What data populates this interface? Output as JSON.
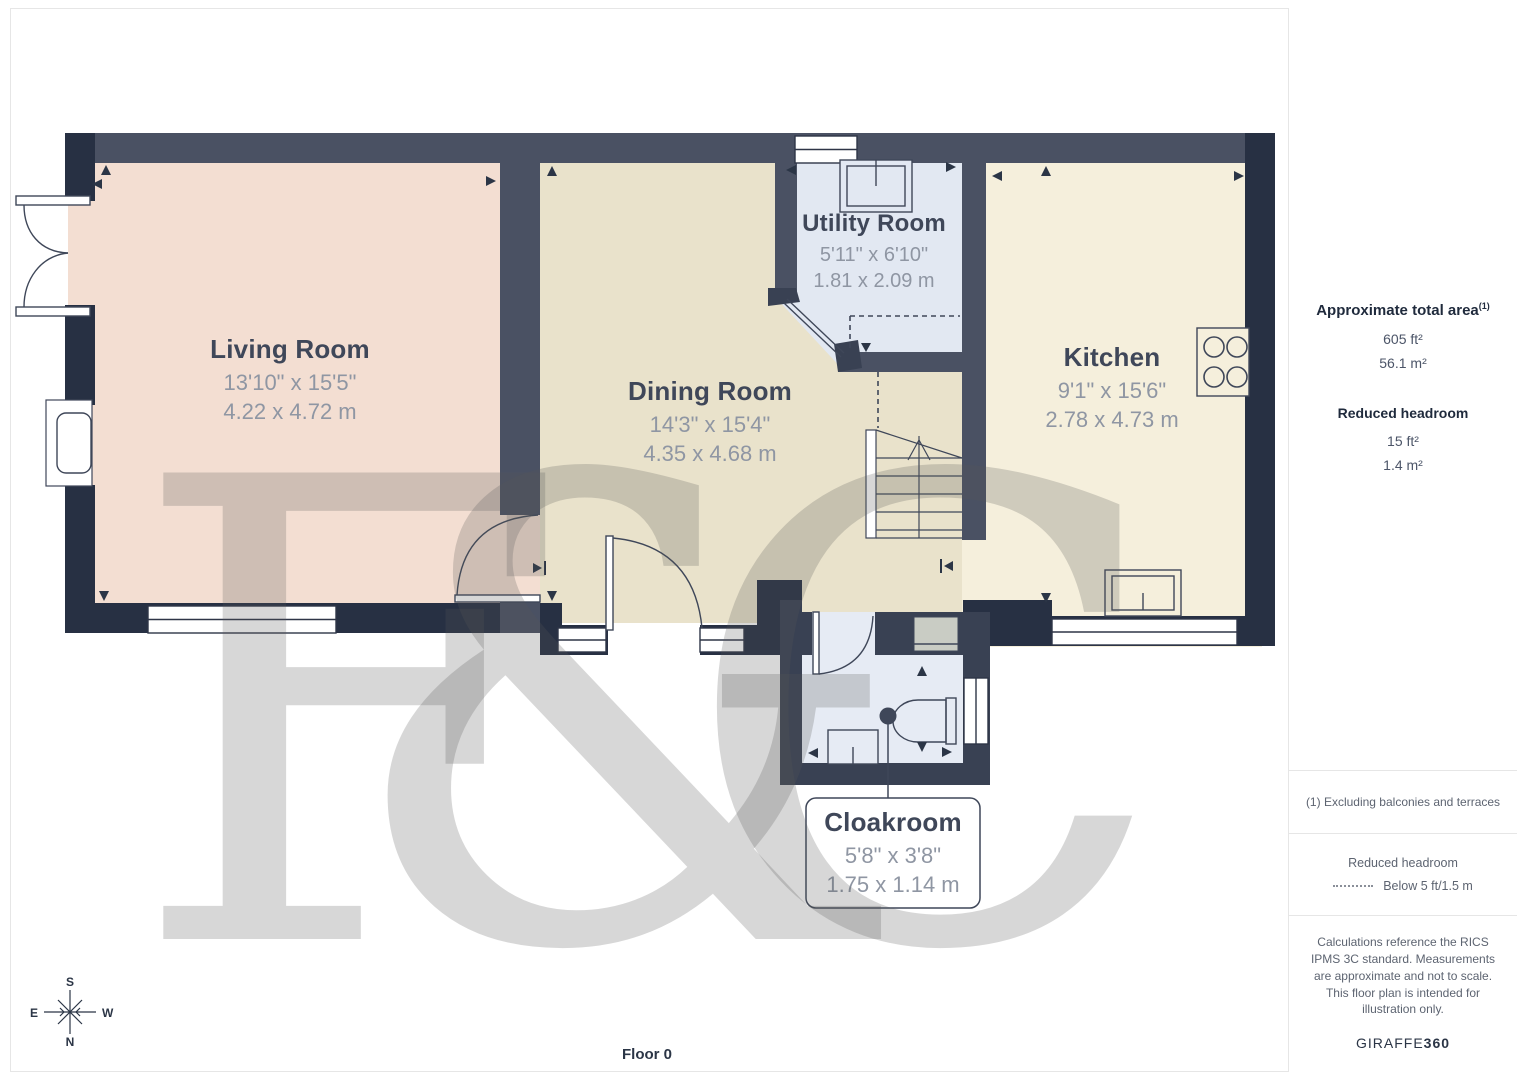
{
  "floor_label": "Floor 0",
  "watermark": "F&C",
  "compass": {
    "top": "S",
    "left": "E",
    "right": "W",
    "bottom": "N"
  },
  "rooms": [
    {
      "name": "Living Room",
      "imperial": "13'10\" x 15'5\"",
      "metric": "4.22 x 4.72 m"
    },
    {
      "name": "Dining Room",
      "imperial": "14'3\" x 15'4\"",
      "metric": "4.35 x 4.68 m"
    },
    {
      "name": "Utility Room",
      "imperial": "5'11\" x 6'10\"",
      "metric": "1.81 x 2.09 m"
    },
    {
      "name": "Kitchen",
      "imperial": "9'1\" x 15'6\"",
      "metric": "2.78 x 4.73 m"
    },
    {
      "name": "Cloakroom",
      "imperial": "5'8\" x 3'8\"",
      "metric": "1.75 x 1.14 m"
    }
  ],
  "sidebar": {
    "total_area": {
      "heading": "Approximate total area",
      "footnote_marker": "(1)",
      "ft": "605 ft²",
      "m": "56.1 m²"
    },
    "reduced_headroom": {
      "heading": "Reduced headroom",
      "ft": "15 ft²",
      "m": "1.4 m²"
    },
    "footnote": "(1) Excluding balconies and terraces",
    "legend": {
      "heading": "Reduced headroom",
      "label": "Below 5 ft/1.5 m"
    },
    "disclaimer": "Calculations reference the RICS IPMS 3C standard. Measurements are approximate and not to scale. This floor plan is intended for illustration only.",
    "brand": {
      "name": "GIRAFFE",
      "suffix": "360"
    }
  },
  "colors": {
    "wall_dark": "#273043",
    "wall_mid": "#4a5163",
    "wall_cloak": "#394153",
    "living": "#f3ded2",
    "dining": "#e9e2cb",
    "utility": "#e2e8f2",
    "kitchen": "#f5efdc",
    "cloakroom": "#e6ebf4",
    "room_name": "#3f4759",
    "room_dims": "#8f96a3"
  }
}
